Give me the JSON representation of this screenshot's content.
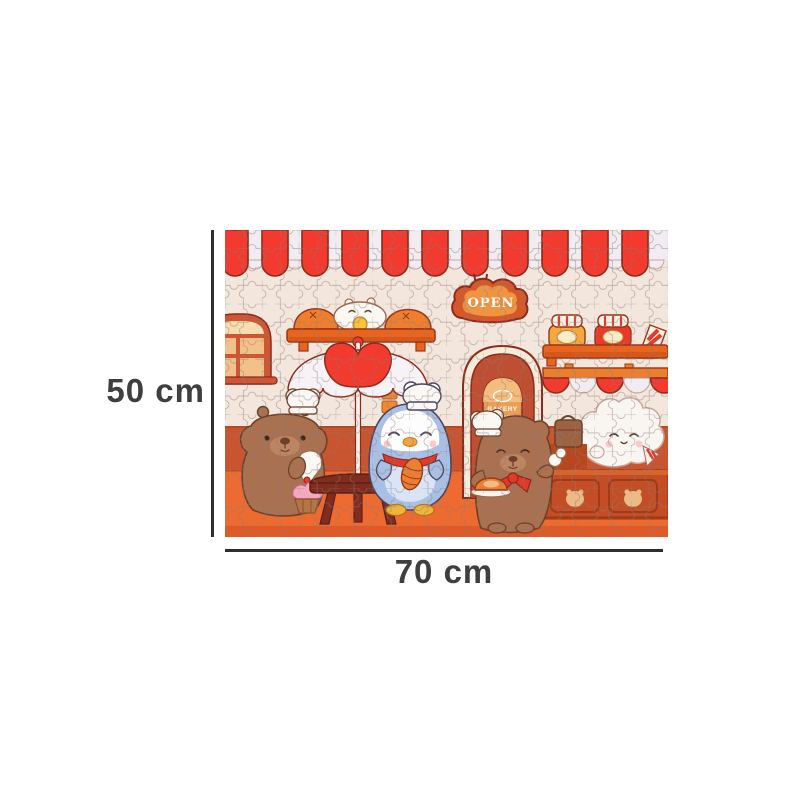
{
  "annotation": {
    "height_label": "50 cm",
    "width_label": "70 cm"
  },
  "puzzle_image": {
    "open_sign_text": "OPEN",
    "door_sign_text": "BAKERY"
  },
  "colors": {
    "dim_line": "#2f2f2f",
    "dim_text": "#3f3f3f",
    "awning_red": "#f23a2e",
    "awning_white": "#f0ecf2",
    "outline_dark_red": "#8e2a1c",
    "wall": "#f3e6dc",
    "wainscot": "#c85430",
    "floor": "#ed6a31",
    "floor_shadow": "#da5724",
    "shelf_orange": "#e8641f",
    "door_rust": "#be4f33",
    "door_window": "#ee9e52",
    "sign_outer": "#d4582a",
    "sign_inner": "#ef9440",
    "penguin_blue": "#a9bfe4",
    "capybara_brown": "#aa7150",
    "table_brown": "#802d1f",
    "cream_white": "#fbf8f4",
    "jar_amber": "#f3a93f",
    "jar_red": "#e8392c",
    "puzzle_line": "#8a7a74"
  }
}
